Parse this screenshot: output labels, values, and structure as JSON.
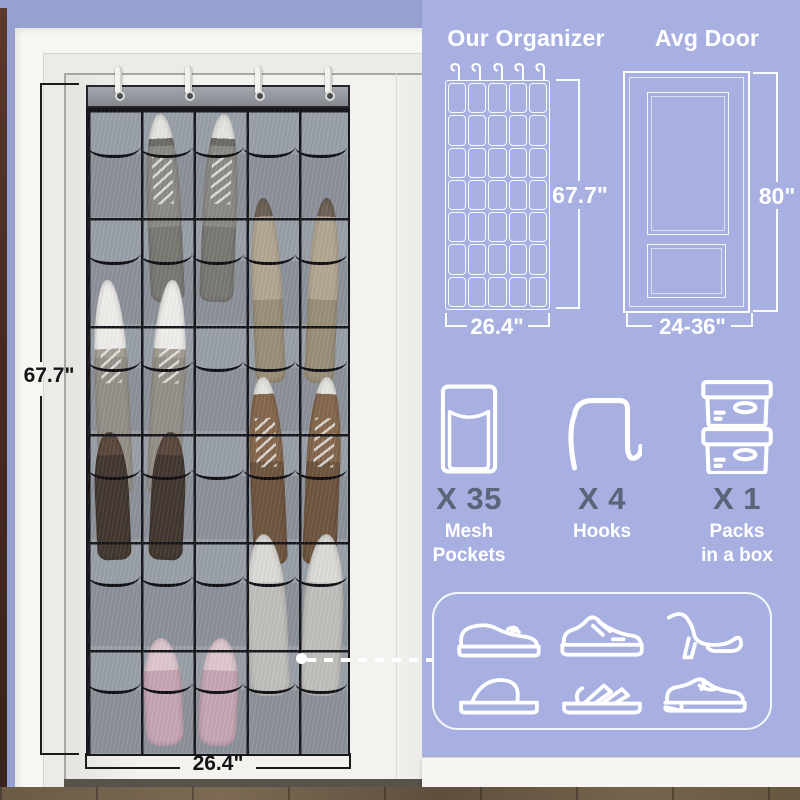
{
  "photo": {
    "height_label": "67.7\"",
    "width_label": "26.4\"",
    "organizer": {
      "rows": 6,
      "cols": 5,
      "hook_count": 4
    },
    "shoes": [
      {
        "row": 1,
        "cols": [
          2,
          3
        ],
        "type": "sneaker-gray",
        "rise": -4,
        "len": 188
      },
      {
        "row": 2,
        "cols": [
          4,
          5
        ],
        "type": "flat-taupe",
        "rise": 19,
        "len": 185
      },
      {
        "row": 3,
        "cols": [
          1,
          2
        ],
        "type": "sneaker-white",
        "rise": 44,
        "len": 215
      },
      {
        "row": 4,
        "cols": [
          1,
          2
        ],
        "type": "shoe-darkbrown",
        "rise": 0,
        "len": 128
      },
      {
        "row": 4,
        "cols": [
          4,
          5
        ],
        "type": "sneaker-brown",
        "rise": 55,
        "len": 188
      },
      {
        "row": 5,
        "cols": [
          4,
          5
        ],
        "type": "slipper-gray",
        "rise": 5,
        "len": 162
      },
      {
        "row": 6,
        "cols": [
          2,
          3
        ],
        "type": "slipper-pink",
        "rise": 8,
        "len": 108
      }
    ]
  },
  "comparison": {
    "organizer": {
      "title": "Our Organizer",
      "height_label": "67.7\"",
      "width_label": "26.4\"",
      "pocket_rows": 7,
      "pocket_cols": 5,
      "hook_count": 5
    },
    "door": {
      "title": "Avg Door",
      "height_label": "80\"",
      "width_label": "24-36\""
    }
  },
  "contents": [
    {
      "icon": "mesh-pocket-icon",
      "count": "X 35",
      "label_lines": [
        "Mesh",
        "Pockets"
      ]
    },
    {
      "icon": "over-door-hook-icon",
      "count": "X 4",
      "label_lines": [
        "Hooks"
      ]
    },
    {
      "icon": "storage-box-icon",
      "count": "X 1",
      "label_lines": [
        "Packs",
        "in a box"
      ]
    }
  ],
  "shoe_panel": {
    "icons": [
      "casual-shoe-icon",
      "sneaker-icon",
      "high-heel-icon",
      "slide-slipper-icon",
      "sandal-icon",
      "loafer-icon"
    ]
  },
  "colors": {
    "panel_bg": "#a7b0e0",
    "wall_bg": "#96a1d1",
    "count_text": "#5b6478",
    "line_white": "#ffffff",
    "dimension_black": "#1b1b1b",
    "organizer_fabric": "#9aa0a8",
    "organizer_trim": "#17171b",
    "floor_wood": "#6b5b46"
  }
}
